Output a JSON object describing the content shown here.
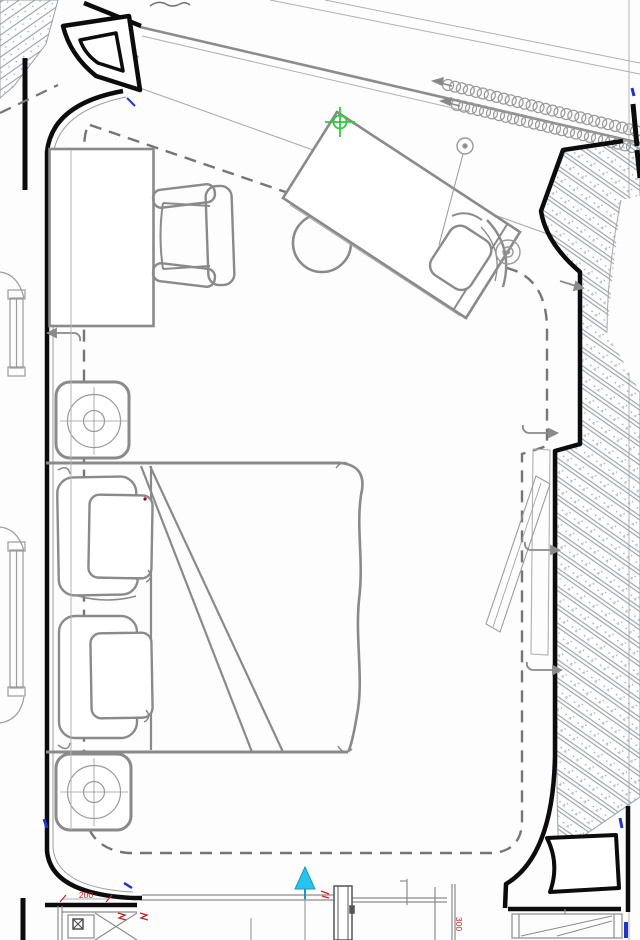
{
  "document": {
    "type": "cad-floor-plan",
    "description": "bedroom plan with bed, desks, nightstands and hatched structural walls"
  },
  "annotations": {
    "dim_200": "200",
    "dim_300": "300"
  },
  "colors": {
    "wall_black": "#0c0c0c",
    "furniture_gray": "#8a8a8a",
    "thin_gray": "#9c9c9c",
    "dashed_gray": "#757575",
    "hatch_gray": "#9aa0a6",
    "green_marker": "#2ecc3d",
    "cyan_marker": "#29c4ee",
    "cyan_marker_edge": "#1899c2",
    "red_annotation": "#c42222",
    "blue_tick": "#2233cc"
  },
  "drawing": {
    "insulation_bands": [
      {
        "id": "1",
        "x1": 448,
        "y1": 85,
        "x2": 636,
        "y2": 131
      },
      {
        "id": "2",
        "x1": 457,
        "y1": 105,
        "x2": 632,
        "y2": 147
      }
    ],
    "circle_radius": 5.5,
    "circle_spacing": 7
  }
}
